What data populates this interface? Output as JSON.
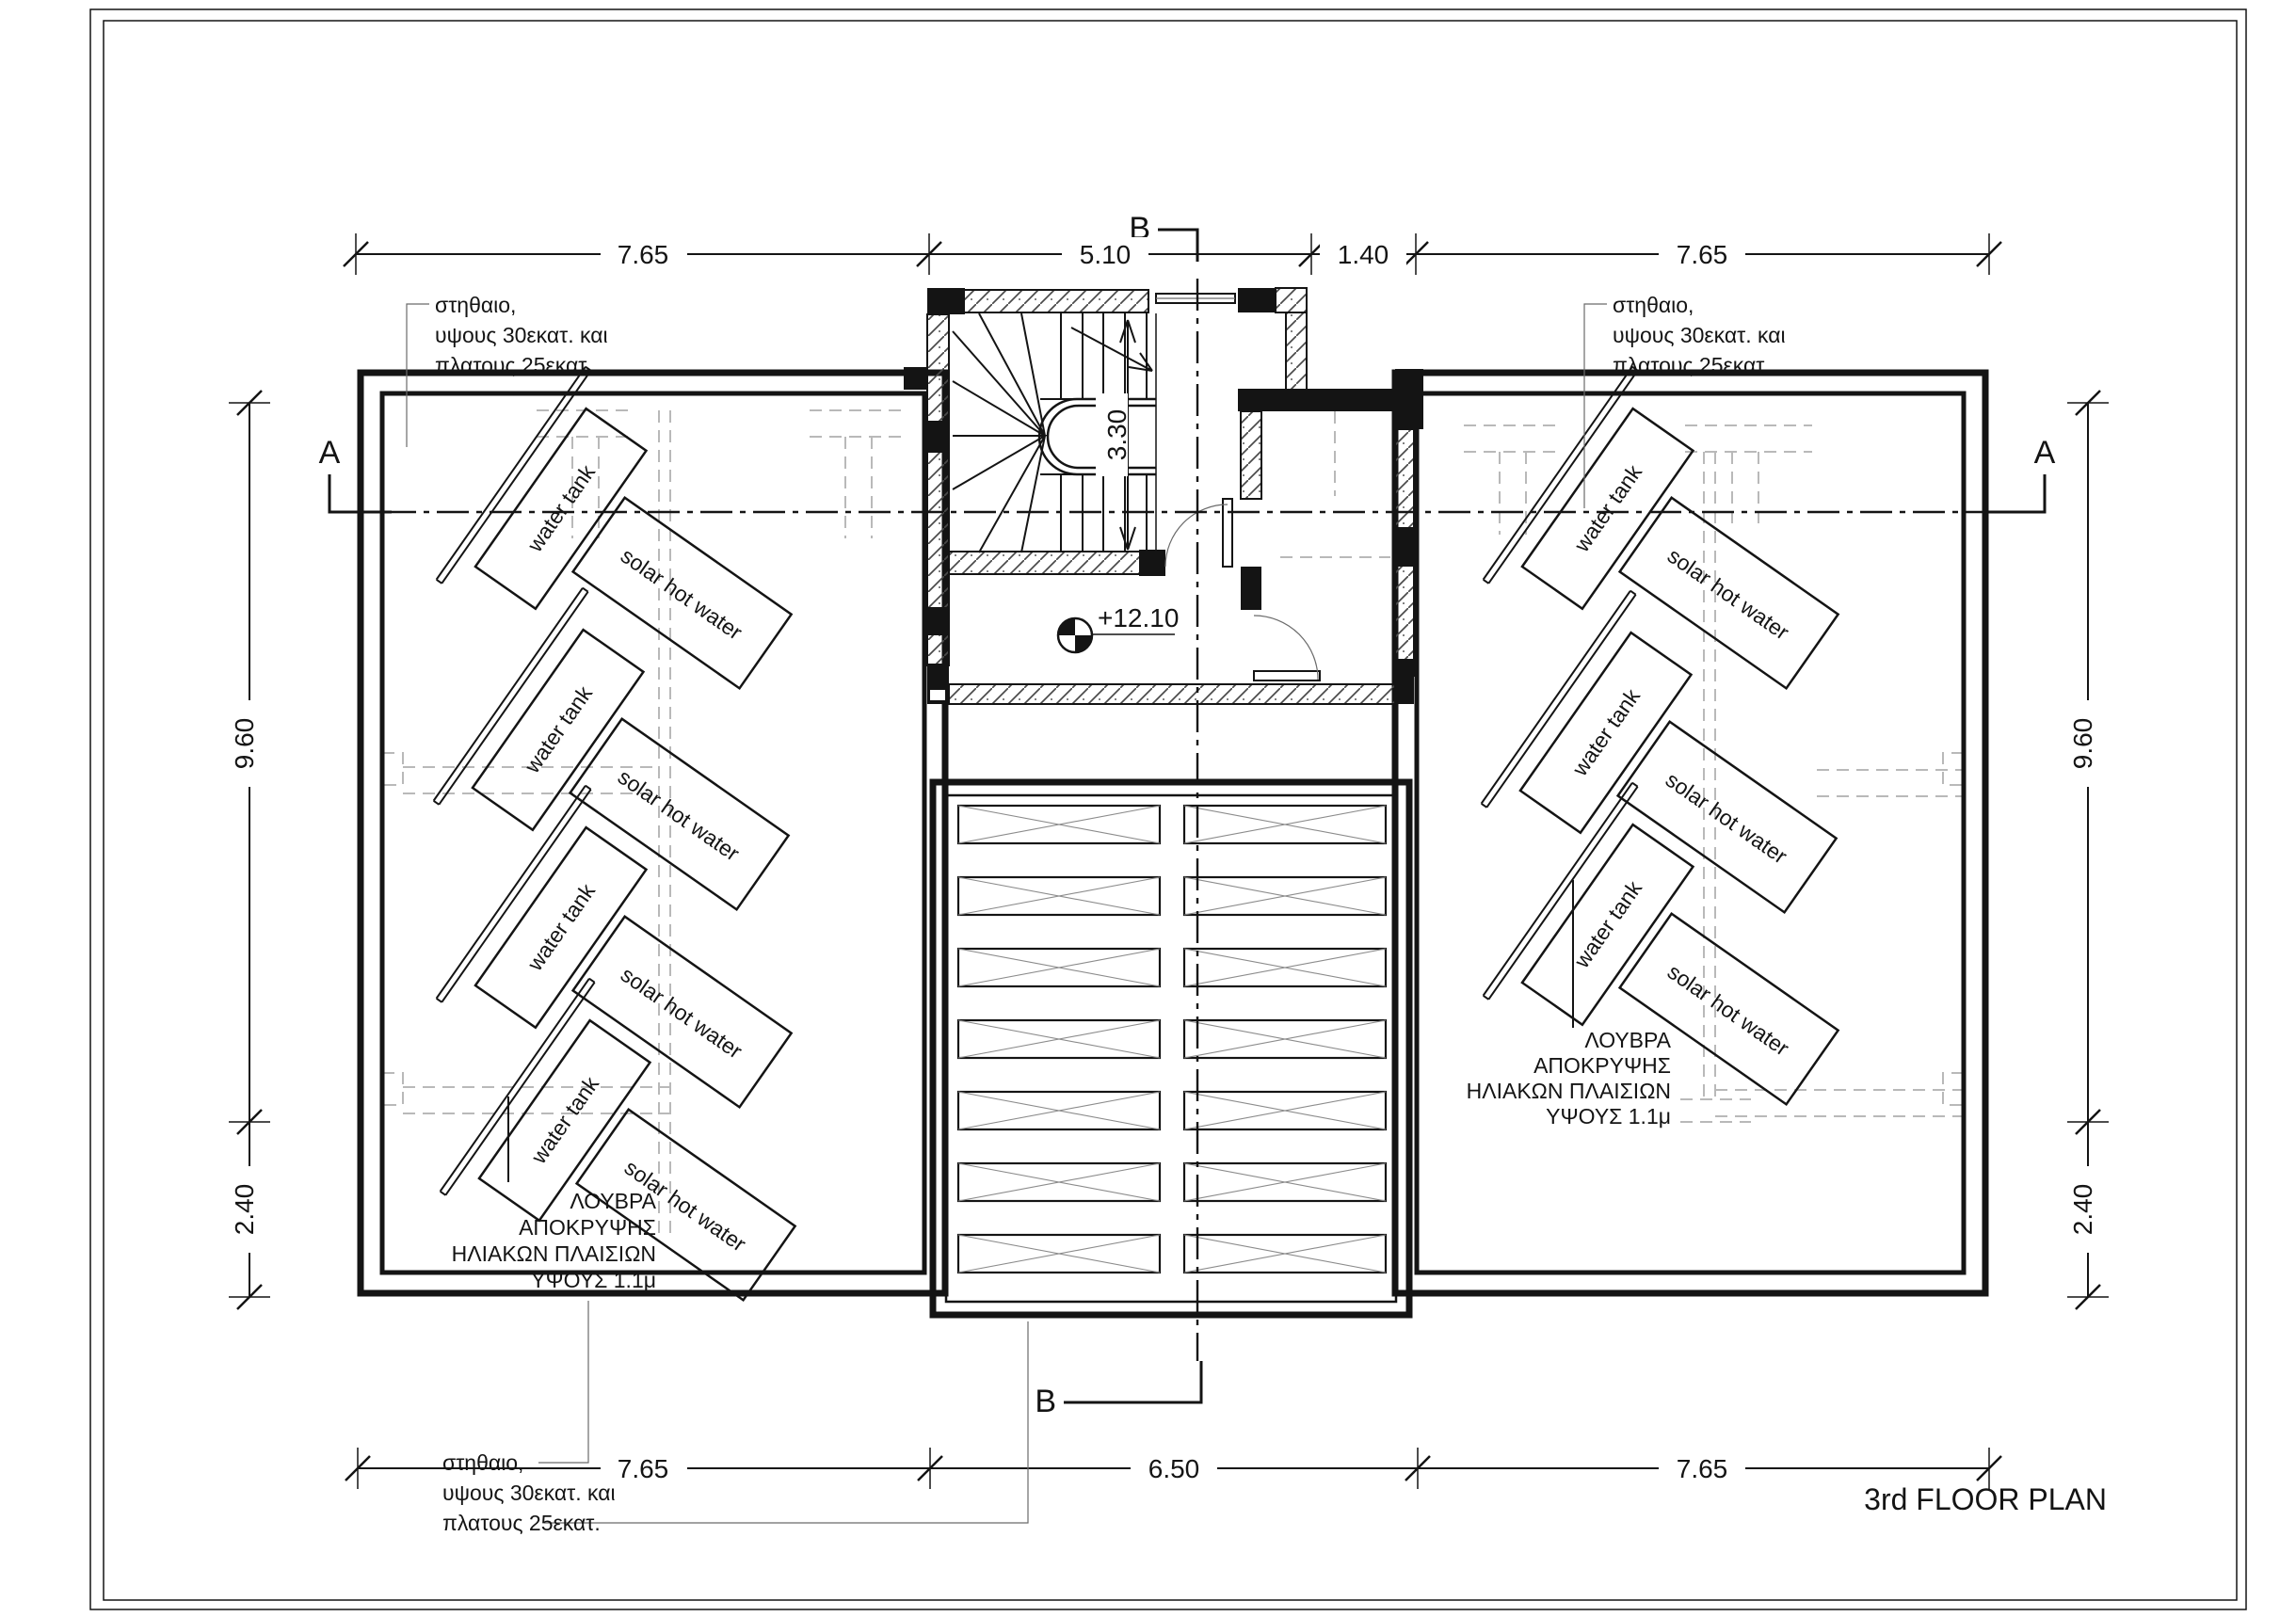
{
  "title": "3rd FLOOR PLAN",
  "sections": {
    "a": "A",
    "b": "B"
  },
  "levels": {
    "roof_level": "+12.10"
  },
  "dimensions": {
    "top": [
      "7.65",
      "5.10",
      "1.40",
      "7.65"
    ],
    "bottom": [
      "7.65",
      "6.50",
      "7.65"
    ],
    "left": [
      "9.60",
      "2.40"
    ],
    "right": [
      "9.60",
      "2.40"
    ],
    "stair_well": "3.30"
  },
  "labels": {
    "water_tank": "water tank",
    "solar_hot_water": "solar hot water"
  },
  "notes": {
    "parapet": [
      "στηθαιο,",
      "υψους 30εκατ. και",
      "πλατους 25εκατ."
    ],
    "louvers": [
      "ΛΟΥΒΡΑ",
      "ΑΠΟΚΡΥΨΗΣ",
      "ΗΛΙΑΚΩΝ ΠΛΑΙΣΙΩΝ",
      "ΥΨΟΥΣ 1.1μ"
    ]
  },
  "colors": {
    "line": "#141414",
    "grid": "#b9b9b9",
    "paper": "#ffffff"
  }
}
